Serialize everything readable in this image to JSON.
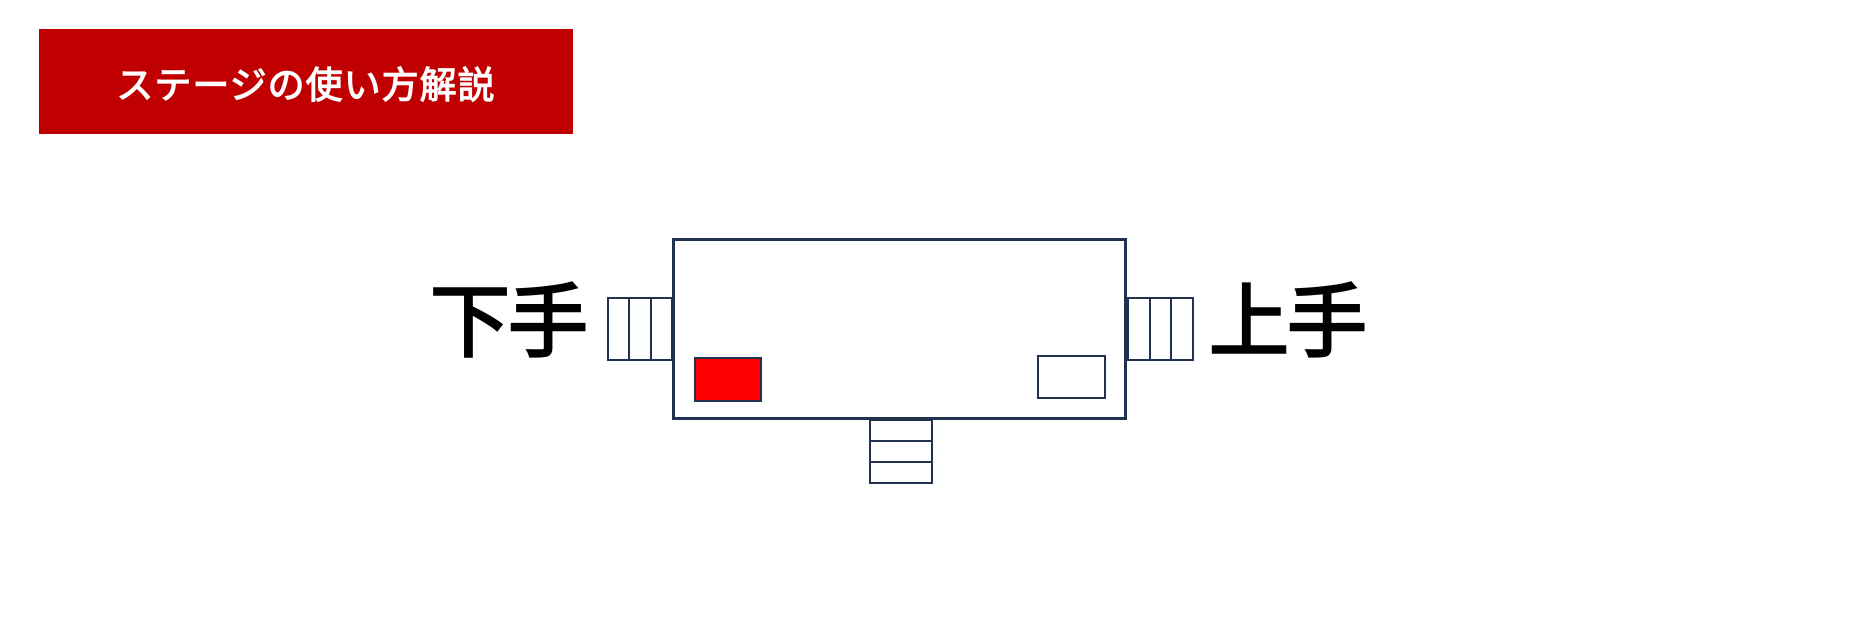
{
  "banner": {
    "title": "ステージの使い方解説",
    "bg_color": "#C00000",
    "text_color": "#FFFFFF"
  },
  "diagram": {
    "outline_color": "#20324E",
    "background_color": "#FFFFFF",
    "stage_left_label": "下手",
    "stage_right_label": "上手",
    "label_color": "#000000",
    "stairs": {
      "left_steps": 3,
      "right_steps": 3,
      "front_steps": 3
    },
    "markers": {
      "red_marker_color": "#FF0000",
      "white_marker_color": "#FFFFFF"
    }
  }
}
